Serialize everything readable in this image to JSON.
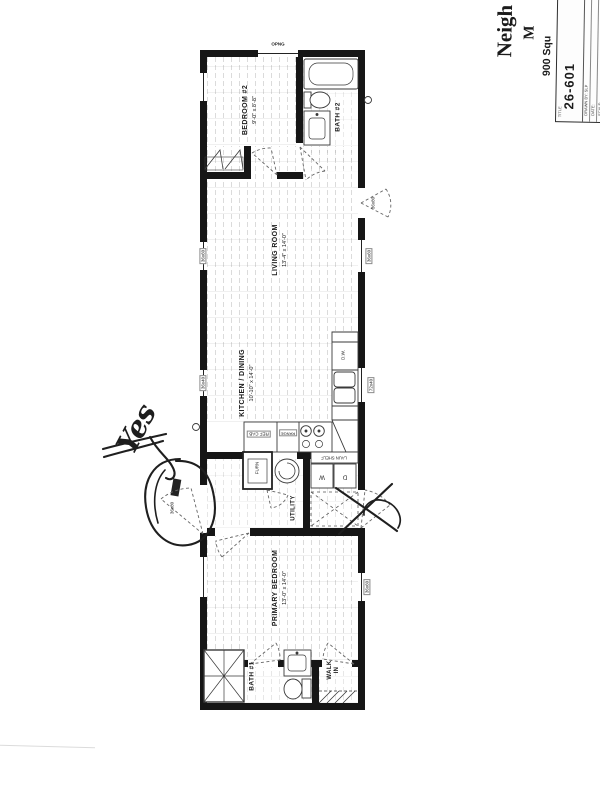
{
  "title_block": {
    "brand_fragment": "Neigh",
    "brand_fragment2": "M",
    "sqft_fragment": "900 Squ",
    "title_label": "TITLE",
    "drawing_number": "26-601",
    "fields": {
      "drawn_by": "DRAWN BY:  SLP",
      "date": "DATE:",
      "scale": "SCALE:"
    }
  },
  "plan": {
    "top_opening_label": "OPNG",
    "rooms": {
      "bedroom2": {
        "name": "BEDROOM #2",
        "dims": "9'-0\" x 8'-8\""
      },
      "bath2": {
        "name": "BATH #2"
      },
      "living": {
        "name": "LIVING ROOM",
        "dims": "13'-4\" x 14'-0\""
      },
      "kitchen": {
        "name": "KITCHEN / DINING",
        "dims": "10'-10\" x 14'-0\""
      },
      "utility": {
        "name": "UTILITY"
      },
      "primary": {
        "name": "PRIMARY BEDROOM",
        "dims": "13'-0\" x 14'-0\""
      },
      "bath1": {
        "name": "BATH #1"
      },
      "walkin": {
        "name": "WALK IN"
      }
    },
    "fixtures": {
      "dishwasher": "D.W.",
      "ref_cab": "REF CAB",
      "range": "RANGE",
      "furnace": "FURN",
      "laundry_shelf": "LAUN SHELF",
      "washer": "W",
      "dryer": "D"
    },
    "openings": {
      "front_door": "36x80",
      "side_door": "36x80",
      "win_living_left": "36x60",
      "win_kitchen_left": "36x40",
      "win_living_right": "36x60",
      "win_kitchen_right": "72x40",
      "win_primary_right": "36x60"
    }
  },
  "annotations": {
    "approval_note": "Yes"
  }
}
